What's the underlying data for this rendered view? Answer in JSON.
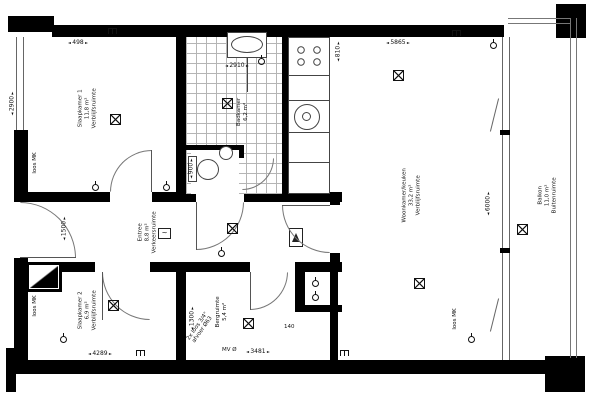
{
  "canvas": {
    "width": 600,
    "height": 400
  },
  "colors": {
    "wall": "#000000",
    "line": "#555555",
    "tile_line": "#b5b5b5",
    "background": "#ffffff"
  },
  "rooms": [
    {
      "name": "Slaapkamer 1",
      "area": "11,8 m²",
      "type": "Verblijfsruimte"
    },
    {
      "name": "Badkamer",
      "area": "6,2 m²",
      "type": ""
    },
    {
      "name": "Woonkamer/keuken",
      "area": "33,2 m²",
      "type": "Verblijfsruimte"
    },
    {
      "name": "Entree",
      "area": "8,8 m²",
      "type": "Verkeersruimte"
    },
    {
      "name": "Slaapkamer 2",
      "area": "6,9 m²",
      "type": "Verblijfsruimte"
    },
    {
      "name": "Bergruimte",
      "area": "5,4 m²",
      "type": ""
    },
    {
      "name": "Balkon",
      "area": "11,0 m²",
      "type": "Buitenruimte"
    }
  ],
  "dimensions": {
    "top_left": "498",
    "top_right": "5865",
    "left_side": "2900",
    "entree_width": "1500",
    "bathroom_width": "2910",
    "toilet_width": "900",
    "living_height": "6000",
    "storage_width": "1300",
    "kitchen": "810",
    "bottom_left": "4289",
    "bottom_middle": "3481",
    "shaft": "140"
  },
  "annotations": {
    "loos_mk": "loos MK",
    "drain_line_1": "2x loos 3/4\"",
    "drain_line_2": "afvoer Ø63",
    "vent": "MV Ø",
    "thermostat_glyph": "~"
  },
  "icons": {
    "ceiling_light": "boxed-x-light-point",
    "wall_light": "three-prong-lamp",
    "socket": "circle-with-stem",
    "door_swing": "quarter-arc",
    "meter_cupboard": "black-triangle-box",
    "intercom": "a-frame-box"
  }
}
